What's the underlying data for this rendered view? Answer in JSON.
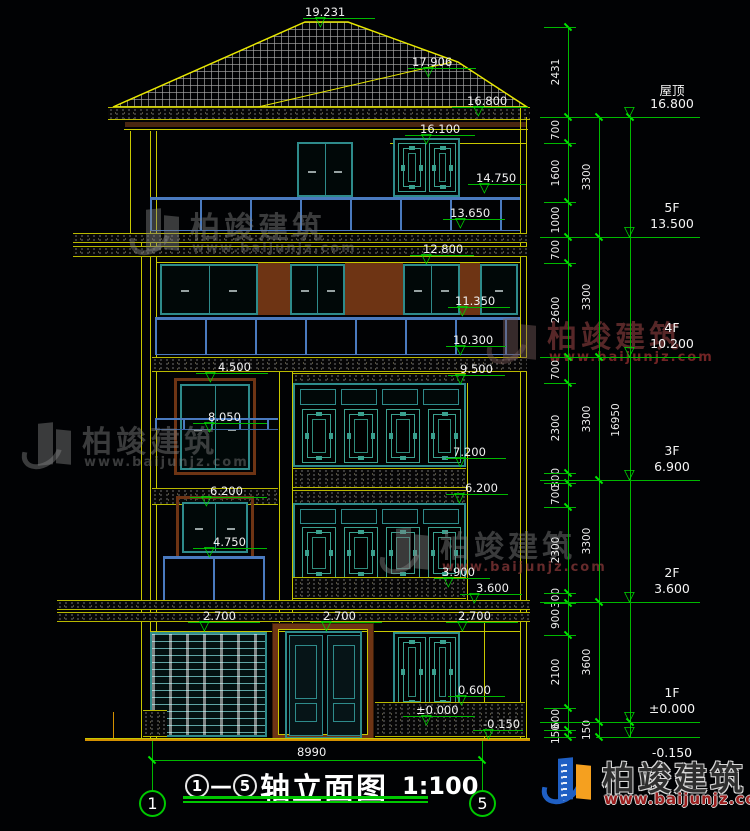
{
  "title": {
    "axis_left": "1",
    "axis_right": "5",
    "dash": "—",
    "name": "轴立面图",
    "scale": "1:100",
    "width_dim": "8990"
  },
  "watermark": {
    "cn": "柏竣建筑",
    "url": "www.baijunjz.com"
  },
  "icons": {
    "triangle": "▽"
  },
  "colors": {
    "green": "#00b800",
    "yellow": "#c8c800",
    "teal": "#2e8b8b",
    "blue": "#4a7abf",
    "brown": "#6e3414",
    "logo_blue": "#1f5fc4",
    "logo_orange": "#f5a01f",
    "logo_red": "#9b1d1d"
  },
  "chains": [
    {
      "x": 568,
      "from": 27,
      "to": 737,
      "ldx": -12,
      "stubs": true,
      "segments": [
        [
          "2431",
          27,
          117
        ],
        [
          "700",
          117,
          143
        ],
        [
          "1600",
          143,
          202
        ],
        [
          "1000",
          202,
          237
        ],
        [
          "700",
          237,
          263
        ],
        [
          "2600",
          263,
          357
        ],
        [
          "700",
          357,
          383
        ],
        [
          "2300",
          383,
          473
        ],
        [
          "300",
          473,
          483
        ],
        [
          "700",
          483,
          507
        ],
        [
          "2300",
          507,
          593
        ],
        [
          "300",
          593,
          603
        ],
        [
          "900",
          603,
          635
        ],
        [
          "2100",
          635,
          708
        ],
        [
          "600",
          708,
          730
        ],
        [
          "150",
          730,
          737
        ]
      ]
    },
    {
      "x": 599,
      "from": 117,
      "to": 737,
      "ldx": -12,
      "stubs": false,
      "segments": [
        [
          "3300",
          117,
          237
        ],
        [
          "3300",
          237,
          357
        ],
        [
          "3300",
          357,
          480
        ],
        [
          "3300",
          480,
          602
        ],
        [
          "3600",
          602,
          722
        ],
        [
          "150",
          722,
          737
        ]
      ]
    },
    {
      "x": 630,
      "from": 117,
      "to": 737,
      "ldx": -14,
      "stubs": false,
      "segments": [
        [
          "16950",
          117,
          722
        ]
      ]
    }
  ],
  "floors_right": [
    {
      "name": "屋顶",
      "elev": "16.800",
      "y": 117
    },
    {
      "name": "5F",
      "elev": "13.500",
      "y": 237
    },
    {
      "name": "4F",
      "elev": "10.200",
      "y": 357
    },
    {
      "name": "3F",
      "elev": "6.900",
      "y": 480
    },
    {
      "name": "2F",
      "elev": "3.600",
      "y": 602
    },
    {
      "name": "1F",
      "elev": "±0.000",
      "y": 722
    },
    {
      "name": "",
      "elev": "-0.150",
      "y": 737,
      "below": true,
      "short": true
    }
  ],
  "building_markers": [
    {
      "v": "19.231",
      "tx": 305,
      "ty": 5,
      "lx": 303,
      "lw": 72,
      "ly": 18,
      "cx": 322
    },
    {
      "v": "17.906",
      "tx": 412,
      "ty": 55,
      "lx": 408,
      "lw": 68,
      "ly": 68,
      "cx": 430
    },
    {
      "v": "16.800",
      "tx": 467,
      "ty": 94,
      "lx": 452,
      "lw": 76,
      "ly": 107,
      "cx": 480
    },
    {
      "v": "16.100",
      "tx": 420,
      "ty": 122,
      "lx": 405,
      "lw": 70,
      "ly": 135,
      "cx": 428
    },
    {
      "v": "14.750",
      "tx": 476,
      "ty": 171,
      "lx": 468,
      "lw": 58,
      "ly": 184,
      "cx": 486
    },
    {
      "v": "13.650",
      "tx": 450,
      "ty": 206,
      "lx": 443,
      "lw": 62,
      "ly": 219,
      "cx": 462
    },
    {
      "v": "12.800",
      "tx": 423,
      "ty": 242,
      "lx": 410,
      "lw": 64,
      "ly": 255,
      "cx": 428
    },
    {
      "v": "11.350",
      "tx": 455,
      "ty": 294,
      "lx": 448,
      "lw": 62,
      "ly": 307,
      "cx": 464
    },
    {
      "v": "10.300",
      "tx": 453,
      "ty": 333,
      "lx": 446,
      "lw": 60,
      "ly": 346,
      "cx": 462
    },
    {
      "v": "9.500",
      "tx": 460,
      "ty": 362,
      "lx": 448,
      "lw": 57,
      "ly": 375,
      "cx": 462
    },
    {
      "v": "4.500",
      "tx": 218,
      "ty": 360,
      "lx": 196,
      "lw": 72,
      "ly": 373,
      "cx": 212
    },
    {
      "v": "8.050",
      "tx": 208,
      "ty": 410,
      "lx": 193,
      "lw": 74,
      "ly": 423,
      "cx": 211
    },
    {
      "v": "7.200",
      "tx": 453,
      "ty": 445,
      "lx": 446,
      "lw": 60,
      "ly": 458,
      "cx": 462
    },
    {
      "v": "6.200",
      "tx": 465,
      "ty": 481,
      "lx": 446,
      "lw": 62,
      "ly": 494,
      "cx": 461
    },
    {
      "v": "6.200",
      "tx": 210,
      "ty": 484,
      "lx": 190,
      "lw": 77,
      "ly": 497,
      "cx": 208
    },
    {
      "v": "4.750",
      "tx": 213,
      "ty": 535,
      "lx": 193,
      "lw": 74,
      "ly": 548,
      "cx": 211
    },
    {
      "v": "3.900",
      "tx": 442,
      "ty": 565,
      "lx": 434,
      "lw": 56,
      "ly": 578,
      "cx": 450
    },
    {
      "v": "3.600",
      "tx": 476,
      "ty": 581,
      "lx": 460,
      "lw": 62,
      "ly": 594,
      "cx": 476
    },
    {
      "v": "2.700",
      "tx": 203,
      "ty": 609,
      "lx": 188,
      "lw": 72,
      "ly": 622,
      "cx": 206
    },
    {
      "v": "2.700",
      "tx": 323,
      "ty": 609,
      "lx": 310,
      "lw": 72,
      "ly": 622,
      "cx": 328
    },
    {
      "v": "2.700",
      "tx": 458,
      "ty": 609,
      "lx": 446,
      "lw": 72,
      "ly": 622,
      "cx": 464
    },
    {
      "v": "0.600",
      "tx": 458,
      "ty": 683,
      "lx": 448,
      "lw": 57,
      "ly": 696,
      "cx": 463
    },
    {
      "v": "±0.000",
      "tx": 416,
      "ty": 703,
      "lx": 403,
      "lw": 72,
      "ly": 716,
      "cx": 428
    },
    {
      "v": "-0.150",
      "tx": 483,
      "ty": 717,
      "lx": 473,
      "lw": 50,
      "ly": 730,
      "cx": 490
    }
  ]
}
